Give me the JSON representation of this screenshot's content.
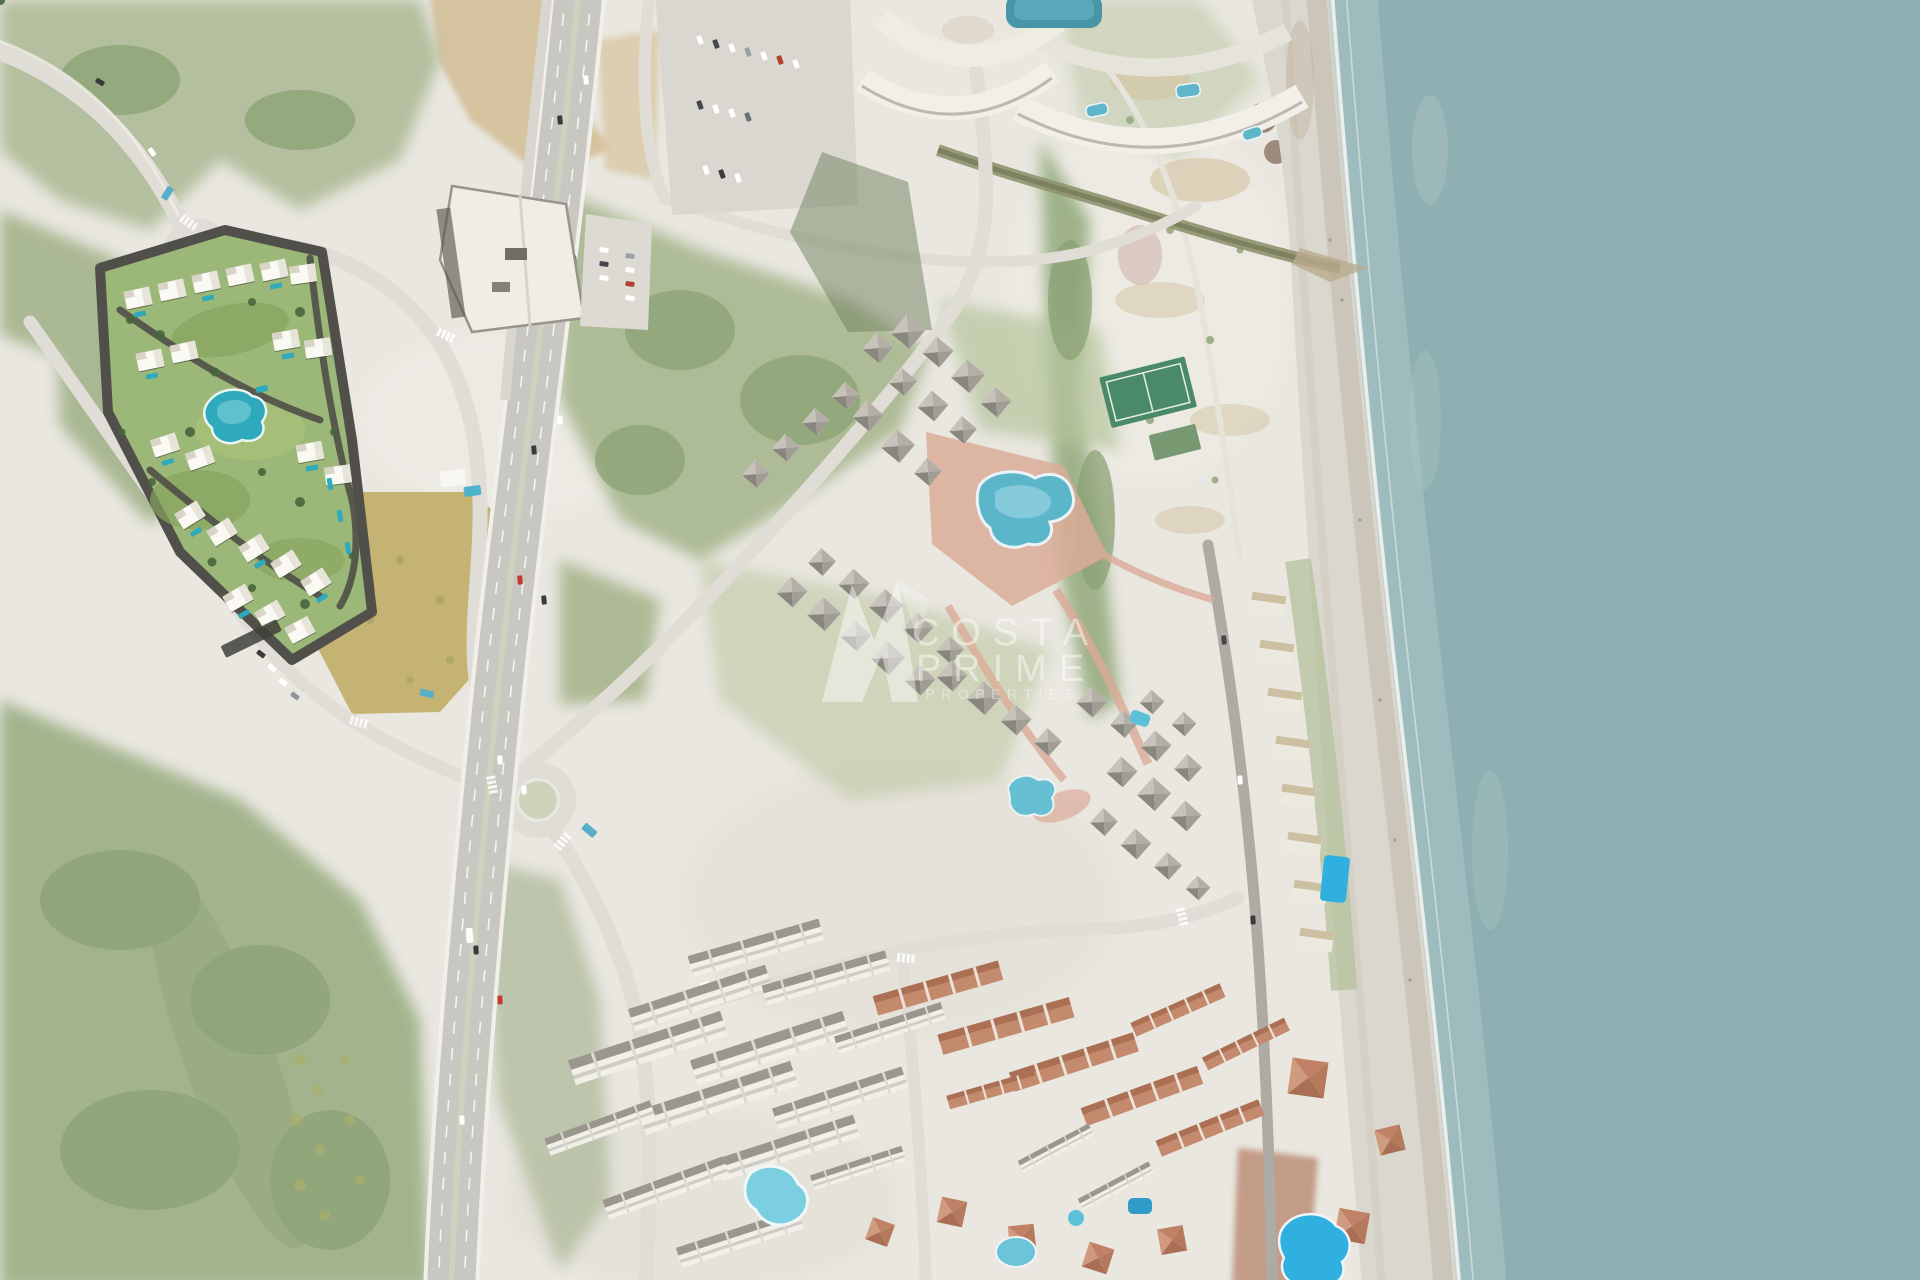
{
  "watermark": {
    "logo_icon": "costa-prime-mark",
    "line1": "COSTA",
    "line2": "PRIME",
    "line3": "PROPERTIES"
  },
  "colors": {
    "land": "#e9e7e0",
    "sea": "#8fb0b2",
    "sea_shallow": "#b2ccc9",
    "surf_foam": "#f3f6f2",
    "beach_sand": "#dad7ce",
    "beach_wet_sand": "#c9c3b6",
    "vegetation": "#b3bf9e",
    "forest": "#a3b48d",
    "dirt": "#d4bf99",
    "vacant_field": "#c3b06e",
    "road_light": "#dfddd6",
    "highway_asphalt": "#c9c7c1",
    "road_dark": "#adaba3",
    "dev_lawn": "#9cb878",
    "dev_road": "#514f49",
    "dev_pool_teal": "#2fa9bc",
    "resort_pool_blue": "#5cb6ca",
    "bright_pool_blue": "#2fb0e0",
    "plaza_terracotta": "#dbab98",
    "tennis_green": "#4b8a68",
    "building_white": "#f2f0e9",
    "roof_gray": "#9a968d",
    "roof_red": "#c48a6d",
    "watermark": "#ffffff"
  }
}
